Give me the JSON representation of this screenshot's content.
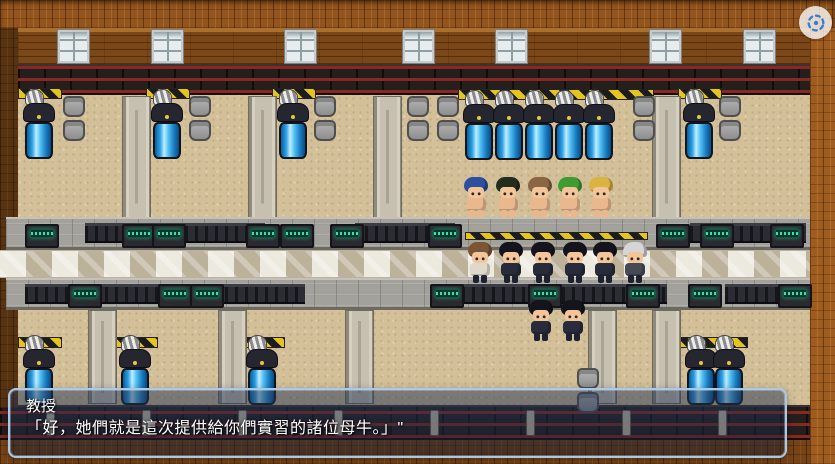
{
  "dialog": {
    "speaker": "教授",
    "text": "「好，她們就是這次提供給你們實習的諸位母牛。」\""
  },
  "hud": {
    "capture_button_icon": "screen-capture-icon",
    "capture_icon_color": "#3f7dca",
    "capture_bg_color": "#fafafa"
  },
  "palette": {
    "dialog_border": "#a9c9e8",
    "dialog_fill": "rgba(28,40,66,0.5)",
    "wood": "#93551d",
    "wall": "#7c4716",
    "floor_sand": "#d3c098",
    "stone": "#a3a19b",
    "tank_blue": "#2aa3e8",
    "hazard_yellow": "#e6c41e",
    "console_green": "#2ee8a2",
    "rail_red": "#872823"
  },
  "scene": {
    "windows_x": [
      58,
      152,
      285,
      403,
      496,
      650,
      744
    ],
    "upper_pillars": {
      "y": 96,
      "h": 122,
      "x": [
        122,
        248,
        373,
        652
      ]
    },
    "lower_pillars": {
      "y": 310,
      "h": 94,
      "x": [
        88,
        218,
        345,
        588,
        652
      ]
    },
    "hazards": [
      {
        "x": 18,
        "y": 88,
        "w": 44
      },
      {
        "x": 146,
        "y": 88,
        "w": 44
      },
      {
        "x": 272,
        "y": 88,
        "w": 44
      },
      {
        "x": 678,
        "y": 88,
        "w": 44
      },
      {
        "x": 458,
        "y": 89,
        "w": 196
      },
      {
        "x": 18,
        "y": 337,
        "w": 44
      },
      {
        "x": 114,
        "y": 337,
        "w": 44
      },
      {
        "x": 241,
        "y": 337,
        "w": 44
      },
      {
        "x": 676,
        "y": 337,
        "w": 72
      }
    ],
    "tanks": [
      {
        "x": 22,
        "y": 96
      },
      {
        "x": 150,
        "y": 96
      },
      {
        "x": 276,
        "y": 96
      },
      {
        "x": 682,
        "y": 96
      },
      {
        "x": 462,
        "y": 97
      },
      {
        "x": 492,
        "y": 97
      },
      {
        "x": 522,
        "y": 97
      },
      {
        "x": 552,
        "y": 97
      },
      {
        "x": 582,
        "y": 97
      },
      {
        "x": 22,
        "y": 342
      },
      {
        "x": 118,
        "y": 342
      },
      {
        "x": 245,
        "y": 342
      },
      {
        "x": 684,
        "y": 342
      },
      {
        "x": 712,
        "y": 342
      }
    ],
    "seat_pairs": [
      {
        "x": 62,
        "y": 96
      },
      {
        "x": 188,
        "y": 96
      },
      {
        "x": 313,
        "y": 96
      },
      {
        "x": 406,
        "y": 96
      },
      {
        "x": 436,
        "y": 96
      },
      {
        "x": 632,
        "y": 96
      },
      {
        "x": 718,
        "y": 96
      },
      {
        "x": 576,
        "y": 368
      }
    ],
    "fences": [
      {
        "x": 85,
        "y": 223,
        "w": 180
      },
      {
        "x": 355,
        "y": 223,
        "w": 100
      },
      {
        "x": 690,
        "y": 223,
        "w": 116
      },
      {
        "x": 25,
        "y": 284,
        "w": 280
      },
      {
        "x": 452,
        "y": 284,
        "w": 215
      },
      {
        "x": 725,
        "y": 284,
        "w": 82
      }
    ],
    "consoles": [
      {
        "x": 25,
        "y": 224
      },
      {
        "x": 122,
        "y": 224
      },
      {
        "x": 152,
        "y": 224
      },
      {
        "x": 246,
        "y": 224
      },
      {
        "x": 280,
        "y": 224
      },
      {
        "x": 330,
        "y": 224
      },
      {
        "x": 428,
        "y": 224
      },
      {
        "x": 656,
        "y": 224
      },
      {
        "x": 700,
        "y": 224
      },
      {
        "x": 770,
        "y": 224
      },
      {
        "x": 68,
        "y": 284
      },
      {
        "x": 158,
        "y": 284
      },
      {
        "x": 190,
        "y": 284
      },
      {
        "x": 430,
        "y": 284
      },
      {
        "x": 528,
        "y": 284
      },
      {
        "x": 626,
        "y": 284
      },
      {
        "x": 688,
        "y": 284
      },
      {
        "x": 778,
        "y": 284
      }
    ],
    "center_hazard_stripe": {
      "x": 465,
      "y": 232,
      "w": 183
    },
    "rail_posts_x": [
      46,
      142,
      238,
      334,
      430,
      526,
      622,
      718
    ],
    "characters": [
      {
        "name": "girl-blue-hair",
        "x": 463,
        "y": 177,
        "type": "girl",
        "hair": "#2d4f9f",
        "body": "#e9b88e"
      },
      {
        "name": "girl-black-hair",
        "x": 495,
        "y": 177,
        "type": "girl",
        "hair": "#232d1e",
        "body": "#e9b88e"
      },
      {
        "name": "girl-brown-hair",
        "x": 527,
        "y": 177,
        "type": "girl",
        "hair": "#8a6644",
        "body": "#e9b88e"
      },
      {
        "name": "girl-green-hair",
        "x": 557,
        "y": 177,
        "type": "girl",
        "hair": "#3f9c33",
        "body": "#e9b88e"
      },
      {
        "name": "girl-blonde-hair",
        "x": 588,
        "y": 177,
        "type": "girl",
        "hair": "#d9b442",
        "body": "#e9b88e"
      },
      {
        "name": "npc-casual-student",
        "x": 467,
        "y": 242,
        "type": "casual",
        "hair": "#7a5636",
        "body": "#ded9cb"
      },
      {
        "name": "npc-student",
        "x": 498,
        "y": 242,
        "type": "suit",
        "hair": "#14141c",
        "body": "#272b3a"
      },
      {
        "name": "npc-student",
        "x": 530,
        "y": 242,
        "type": "suit",
        "hair": "#14141c",
        "body": "#272b3a"
      },
      {
        "name": "npc-student",
        "x": 562,
        "y": 242,
        "type": "suit",
        "hair": "#14141c",
        "body": "#272b3a"
      },
      {
        "name": "npc-student",
        "x": 592,
        "y": 242,
        "type": "suit",
        "hair": "#14141c",
        "body": "#272b3a"
      },
      {
        "name": "npc-professor",
        "x": 622,
        "y": 242,
        "type": "elder",
        "hair": "#d6d6d6",
        "body": "#454a56"
      },
      {
        "name": "npc-student",
        "x": 528,
        "y": 300,
        "type": "suit",
        "hair": "#14141c",
        "body": "#272b3a"
      },
      {
        "name": "npc-student",
        "x": 560,
        "y": 300,
        "type": "suit",
        "hair": "#14141c",
        "body": "#272b3a"
      }
    ]
  }
}
